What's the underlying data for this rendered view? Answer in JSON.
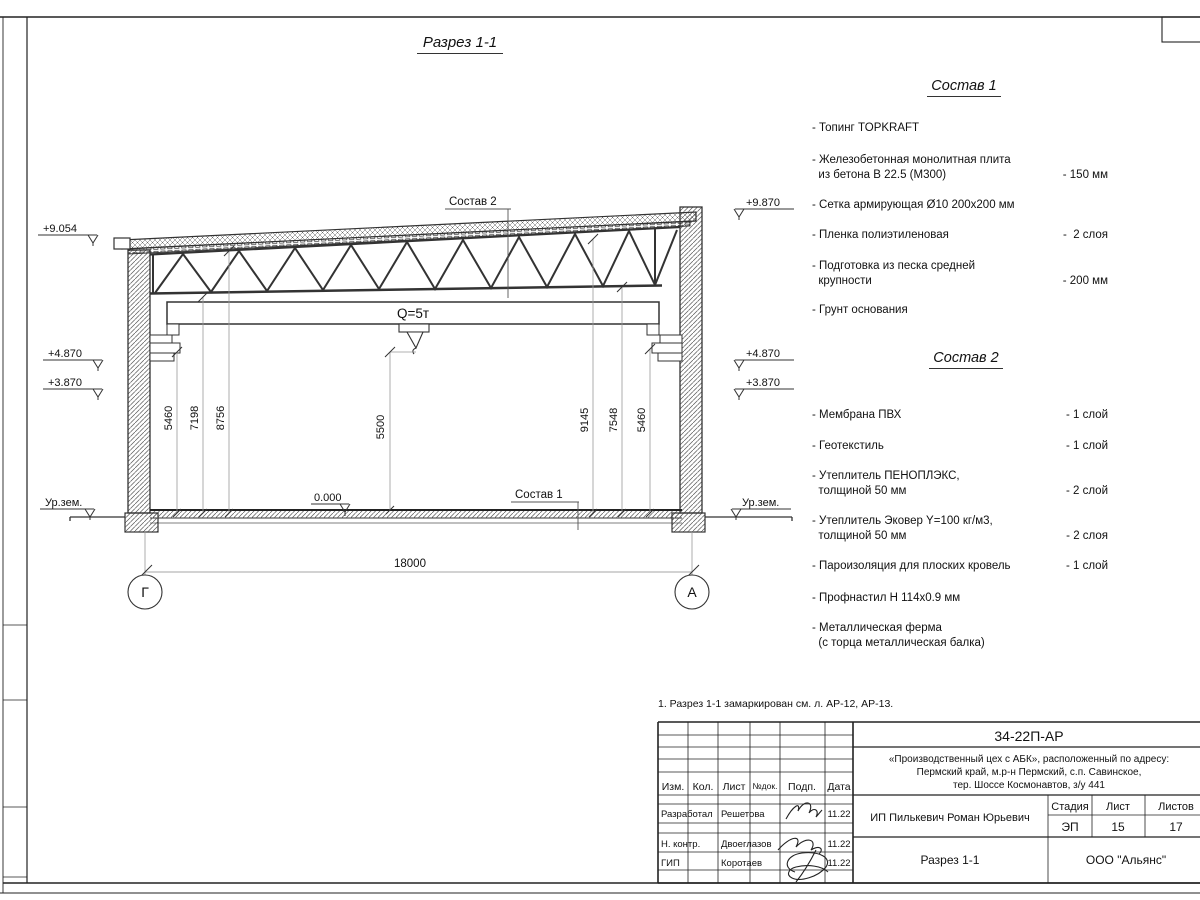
{
  "page": {
    "title": "Разрез 1-1",
    "note": "1. Разрез 1-1 замаркирован см. л. АР-12, АР-13."
  },
  "sostav1": {
    "heading": "Состав 1",
    "items": [
      {
        "text": "- Топинг TOPKRAFT",
        "value": ""
      },
      {
        "text": "- Железобетонная  монолитная плита\n  из бетона В 22.5 (М300)",
        "value": "- 150 мм"
      },
      {
        "text": "- Сетка армирующая Ø10 200х200 мм",
        "value": ""
      },
      {
        "text": "- Пленка полиэтиленовая",
        "value": "-  2 слоя"
      },
      {
        "text": "- Подготовка из песка средней\n  крупности",
        "value": "- 200 мм"
      },
      {
        "text": "- Грунт основания",
        "value": ""
      }
    ]
  },
  "sostav2": {
    "heading": "Состав 2",
    "items": [
      {
        "text": "- Мембрана ПВХ",
        "value": "- 1 слой"
      },
      {
        "text": "- Геотекстиль",
        "value": "- 1 слой"
      },
      {
        "text": "- Утеплитель ПЕНОПЛЭКС,\n  толщиной 50 мм",
        "value": "- 2 слой"
      },
      {
        "text": "- Утеплитель Эковер Y=100 кг/м3,\n  толщиной 50 мм",
        "value": "- 2 слоя"
      },
      {
        "text": "- Пароизоляция для плоских кровель",
        "value": "- 1 слой"
      },
      {
        "text": "- Профнастил Н 114х0.9 мм",
        "value": ""
      },
      {
        "text": "- Металлическая ферма\n  (с торца металлическая балка)",
        "value": ""
      }
    ]
  },
  "drawing": {
    "crane_label": "Q=5т",
    "ref1": "Состав 1",
    "ref2": "Состав 2",
    "zero_level": "0.000",
    "ground_left": "Ур.зем.",
    "ground_right": "Ур.зем.",
    "elev": {
      "l_top": "+9.054",
      "l_mid": "+4.870",
      "l_low": "+3.870",
      "r_top": "+9.870",
      "r_mid": "+4.870",
      "r_low": "+3.870"
    },
    "axes": {
      "left": "Г",
      "right": "А"
    },
    "dims": {
      "span": "18000",
      "mid": "5500",
      "left": [
        "5460",
        "7198",
        "8756"
      ],
      "right": [
        "9145",
        "7548",
        "5460"
      ]
    }
  },
  "titleblock": {
    "doc_number": "34-22П-АР",
    "project": [
      "«Производственный цех с АБК», расположенный по адресу:",
      "Пермский край, м.р-н Пермский, с.п. Савинское,",
      "тер. Шоссе Космонавтов, з/у 441"
    ],
    "client": "ИП Пилькевич Роман Юрьевич",
    "sheet_title": "Разрез 1-1",
    "company": "ООО \"Альянс\"",
    "stage_label": "Стадия",
    "sheet_label": "Лист",
    "sheets_label": "Листов",
    "stage": "ЭП",
    "sheet": "15",
    "sheets": "17",
    "cols": [
      "Изм.",
      "Кол.",
      "Лист",
      "№док.",
      "Подп.",
      "Дата"
    ],
    "rows": [
      {
        "role": "Разработал",
        "name": "Решетова",
        "date": "11.22"
      },
      {
        "role": "Н. контр.",
        "name": "Двоеглазов",
        "date": "11.22"
      },
      {
        "role": "ГИП",
        "name": "Коротаев",
        "date": "11.22"
      }
    ]
  }
}
